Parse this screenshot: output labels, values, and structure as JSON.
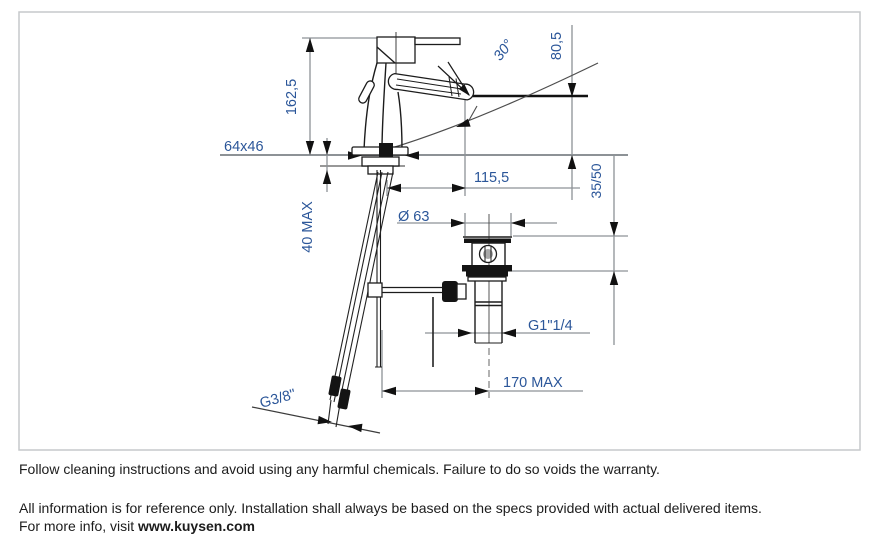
{
  "drawing": {
    "title_hint": "basin-mixer-installation-dimension-drawing",
    "dimensions": {
      "total_height": "162,5",
      "spout_height": "80,5",
      "swivel_angle": "30°",
      "base_plate": "64x46",
      "spout_reach": "115,5",
      "counter_thickness_max": "40 MAX",
      "drain_flange_diameter": "Ø 63",
      "drain_depth_range": "35/50",
      "drain_thread": "G1\"1/4",
      "reach_max": "170 MAX",
      "supply_hose_thread": "G3/8\""
    },
    "colors": {
      "dimension_text": "#2b5699",
      "product_line": "#1c1c1c",
      "dimension_line": "#8d9296",
      "border": "#c6c9cb",
      "background": "#ffffff"
    }
  },
  "footer": {
    "line1": "Follow cleaning instructions and avoid using any harmful chemicals. Failure to do so voids the warranty.",
    "line2": "All information is for reference only. Installation shall always be based on the specs provided with actual delivered items.",
    "line3_prefix": "For more info, visit ",
    "website": "www.kuysen.com"
  }
}
